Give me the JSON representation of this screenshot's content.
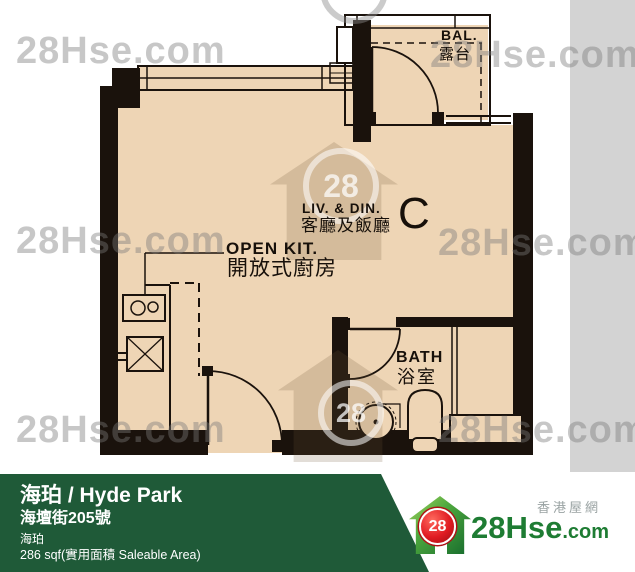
{
  "plan": {
    "unit": "C",
    "labels": {
      "living_en": "LIV. & DIN.",
      "living_zh": "客廳及飯廳",
      "kitchen_en": "OPEN KIT.",
      "kitchen_zh": "開放式廚房",
      "bath_en": "BATH",
      "bath_zh": "浴室",
      "balcony_en": "BAL.",
      "balcony_zh": "露台"
    }
  },
  "watermark": {
    "text": "28Hse.com",
    "badge": "28"
  },
  "footer": {
    "title": "海珀 / Hyde Park",
    "address": "海壇街205號",
    "estate": "海珀",
    "area": "286 sqf(實用面積 Saleable Area)"
  },
  "logo": {
    "badge": "28",
    "brand": "28Hse",
    "suffix": ".com",
    "tagline": "香港屋網"
  },
  "colors": {
    "floor": "#eed5b5",
    "wall": "#1a120c",
    "gray_band": "#d3d3d3",
    "footer_green": "#1f5a38",
    "logo_green": "#1e7c33",
    "logo_red": "#e01b22"
  }
}
